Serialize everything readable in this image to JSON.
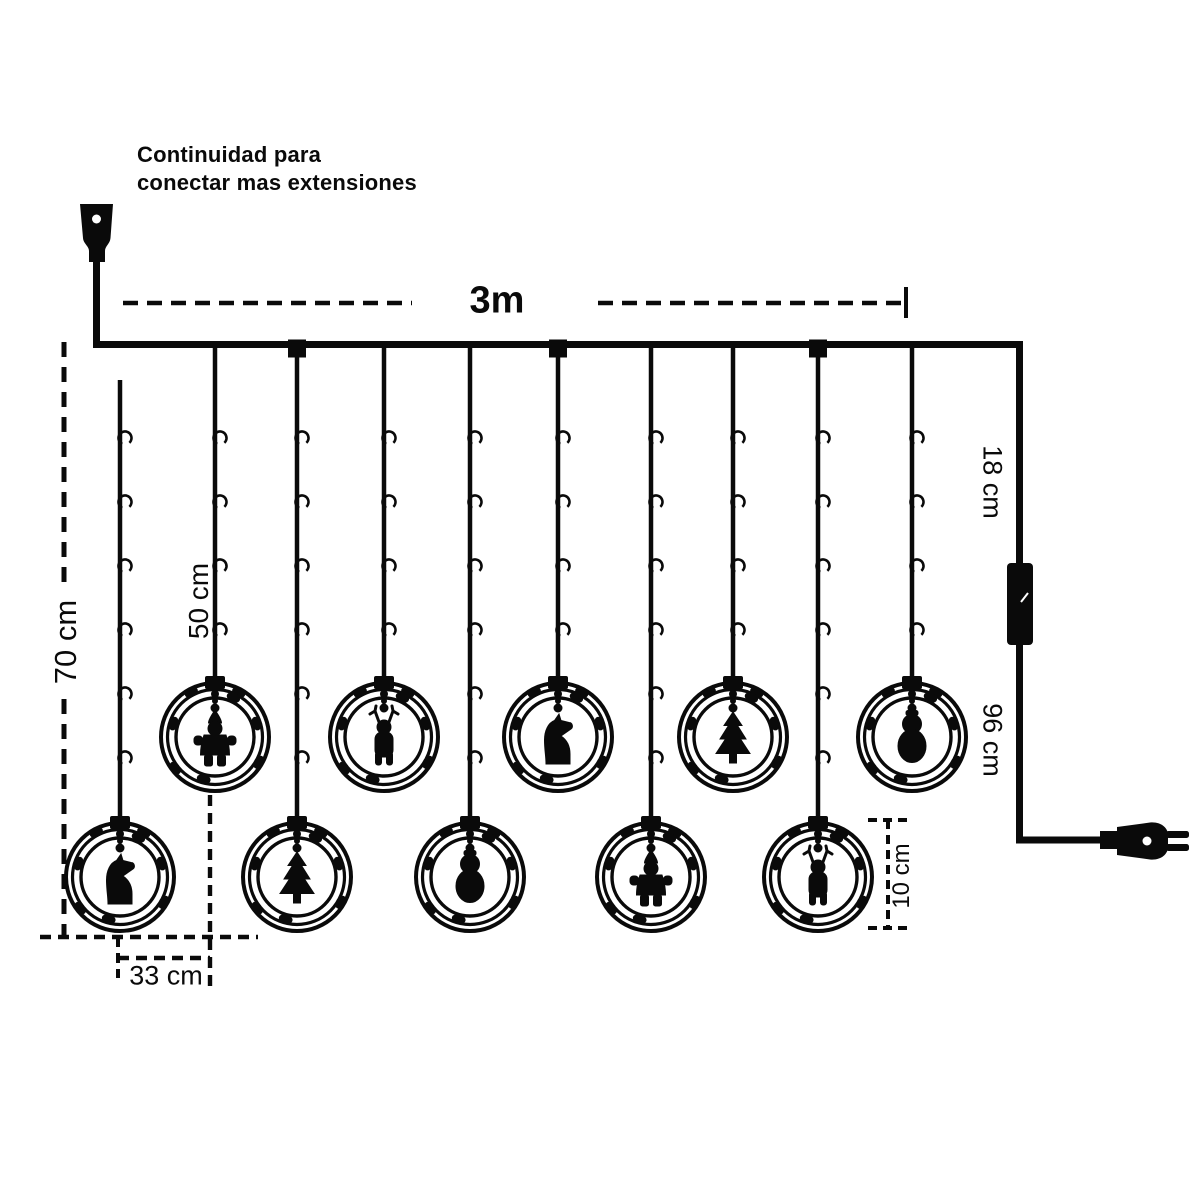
{
  "colors": {
    "ink": "#0a0a0a",
    "background": "#ffffff"
  },
  "note": {
    "line1": "Continuidad para",
    "line2": "conectar mas extensiones"
  },
  "labels": {
    "total_width": "3m",
    "long_drop": "70 cm",
    "short_drop": "50 cm",
    "drop_spacing": "33 cm",
    "lead_top": "18 cm",
    "lead_bottom": "96 cm",
    "ring_diameter": "10 cm"
  },
  "ornaments": [
    {
      "row": "lower",
      "figure": "horse"
    },
    {
      "row": "upper",
      "figure": "santa"
    },
    {
      "row": "lower",
      "figure": "tree"
    },
    {
      "row": "upper",
      "figure": "reindeer"
    },
    {
      "row": "lower",
      "figure": "snowman"
    },
    {
      "row": "upper",
      "figure": "horse"
    },
    {
      "row": "lower",
      "figure": "santa"
    },
    {
      "row": "upper",
      "figure": "tree"
    },
    {
      "row": "lower",
      "figure": "reindeer"
    },
    {
      "row": "upper",
      "figure": "snowman"
    }
  ]
}
